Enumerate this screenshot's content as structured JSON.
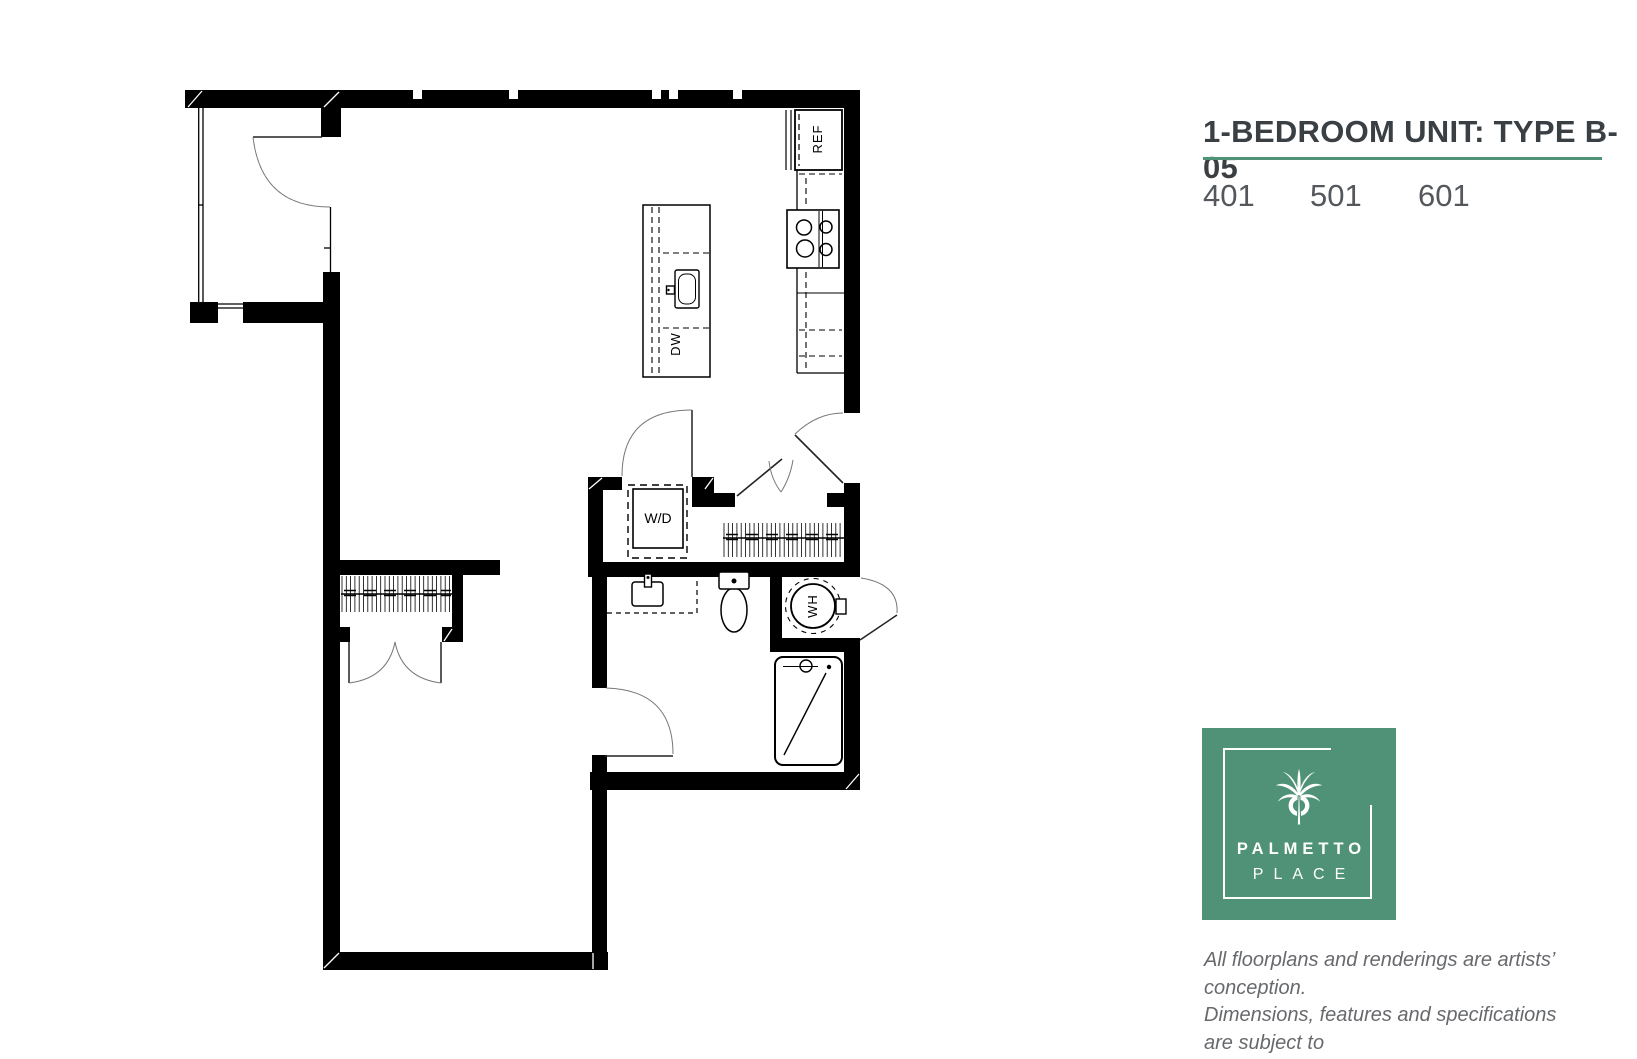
{
  "title": {
    "text": "1-BEDROOM UNIT: TYPE B-05",
    "units": [
      "401",
      "501",
      "601"
    ]
  },
  "plan": {
    "labels": {
      "refrigerator": "REF",
      "dishwasher": "DW",
      "washer_dryer": "W/D",
      "water_heater": "WH"
    }
  },
  "logo": {
    "name_line1": "PALMETTO",
    "name_line2": "PLACE"
  },
  "disclaimer": {
    "line1": "All floorplans and renderings are artists’ conception.",
    "line2": "Dimensions, features and specifications are subject to",
    "line3": "change at the discretion of the builder."
  },
  "colors": {
    "brand_green": "#4F9278",
    "title_text": "#3A3F44",
    "unit_numbers": "#54585C",
    "disclaimer_text": "#67696C",
    "plan_lines": "#000000"
  }
}
